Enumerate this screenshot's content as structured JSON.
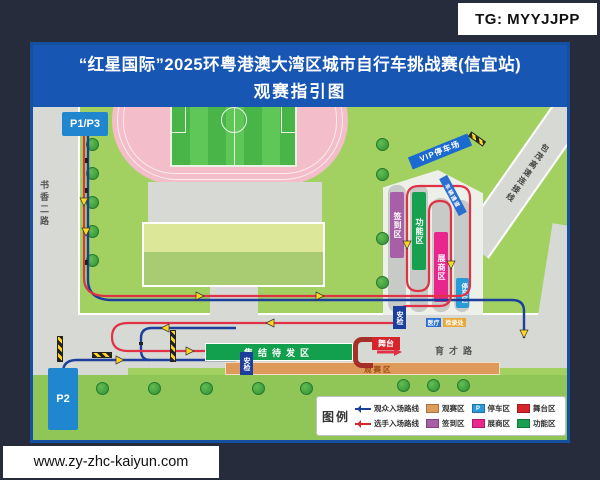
{
  "watermarks": {
    "top": "TG: MYYJJPP",
    "bottom": "www.zy-zhc-kaiyun.com"
  },
  "title": {
    "line1": "“红星国际”2025环粤港澳大湾区城市自行车挑战赛(信宜站)",
    "line2": "观赛指引图"
  },
  "roads": {
    "shuxiang": "书香二路",
    "yucai": "育才路",
    "baomao": "包茂高速连接线"
  },
  "parking": {
    "p1p3": "P1/P3",
    "p2": "P2",
    "vip": "VIP停车场",
    "parking_strip": "停车区"
  },
  "zones": {
    "checkin": "签到区",
    "function": "功能区",
    "exhibitor": "展商区",
    "assembly": "集结待发区",
    "viewing": "观赛区",
    "stage": "舞台"
  },
  "small_labels": {
    "security1": "安检",
    "security2": "安检",
    "medical": "医疗",
    "kitcheck": "检录处",
    "vehicle_channel": "车辆通道"
  },
  "legend": {
    "title": "图例",
    "p_glyph": "P",
    "items": [
      {
        "type": "route",
        "color": "#1c3f9b",
        "label": "观众入场路线"
      },
      {
        "type": "swatch",
        "color": "#dd9a5b",
        "label": "观赛区"
      },
      {
        "type": "swatch",
        "color": "#2a9ad8",
        "label": "停车区"
      },
      {
        "type": "swatch",
        "color": "#d5252b",
        "label": "舞台区"
      },
      {
        "type": "route",
        "color": "#d5252b",
        "label": "选手入场路线"
      },
      {
        "type": "swatch",
        "color": "#a75fa8",
        "label": "签到区"
      },
      {
        "type": "swatch",
        "color": "#e9258e",
        "label": "展商区"
      },
      {
        "type": "swatch",
        "color": "#17a050",
        "label": "功能区"
      }
    ]
  },
  "colors": {
    "title_bar": "#1856b4",
    "map_border": "#14509f",
    "grass": "#a2d162",
    "road": "#d7d9d5",
    "track_pink": "#f3bdc9",
    "route_spectator": "#1c3f9b",
    "route_rider": "#e03246",
    "arrow_yellow": "#ffd520",
    "zone_checkin": "#a75fa8",
    "zone_function": "#17a050",
    "zone_exhibitor": "#e9258e",
    "zone_viewing": "#dd9a5b",
    "zone_stage": "#d5252b",
    "zone_parking": "#2a9ad8",
    "assembly_green": "#12a04f",
    "parking_sign_blue": "#1f86cf"
  }
}
